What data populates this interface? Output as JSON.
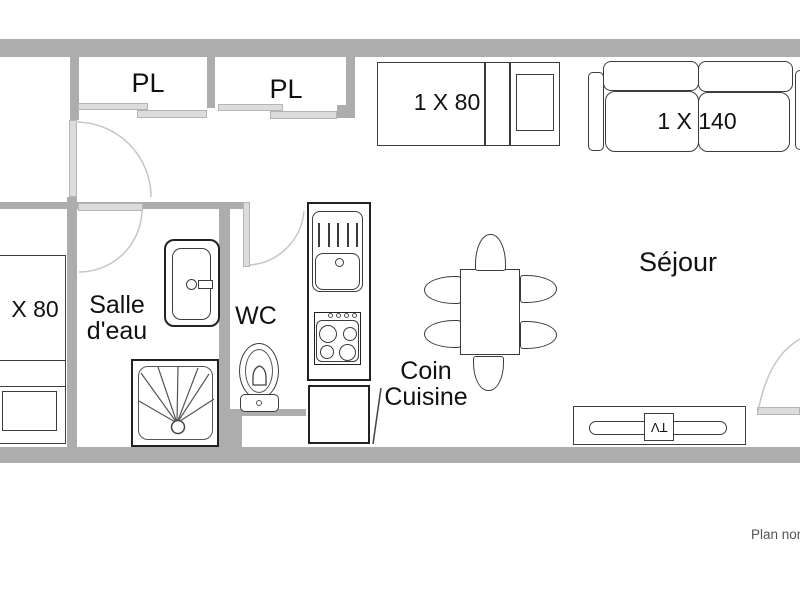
{
  "labels": {
    "closet_left": "PL",
    "closet_right": "PL",
    "single_bed_top": "1 X 80",
    "sofa_bed": "1 X 140",
    "single_bed_left": "X 80",
    "bathroom_1": "Salle",
    "bathroom_2": "d'eau",
    "wc": "WC",
    "kitchen_1": "Coin",
    "kitchen_2": "Cuisine",
    "living_room": "Séjour",
    "tv": "TV",
    "footnote": "Plan non"
  },
  "colors": {
    "wall": "#adadad",
    "furniture_outline": "#3c3c3c",
    "strong_outline": "#222222",
    "door_leaf_fill": "#dcdcdc",
    "door_leaf_border": "#b5b5b5",
    "door_swing": "#c6c6c6",
    "label_text": "#111111",
    "footnote_text": "#555555"
  }
}
